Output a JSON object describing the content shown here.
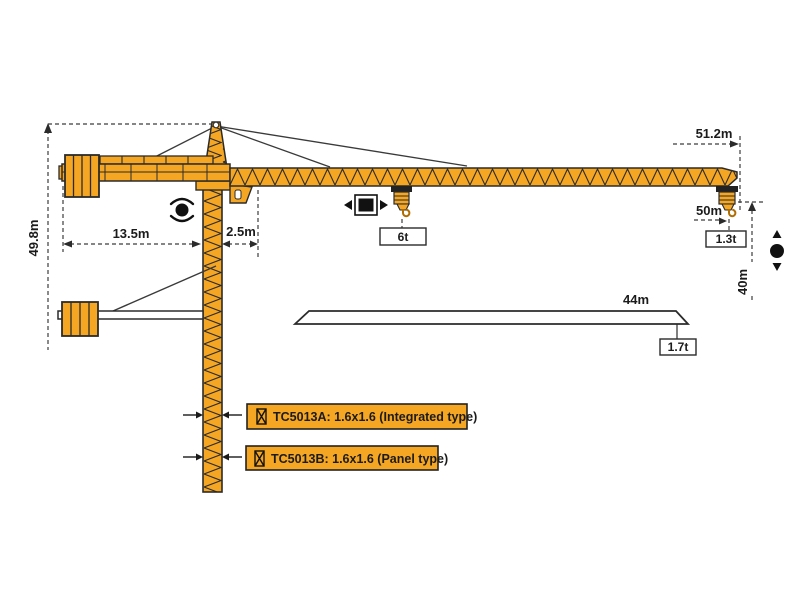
{
  "diagram": {
    "type": "tower-crane-dimension-diagram",
    "model_family": "TC5013",
    "colors": {
      "crane_orange": "#F5A623",
      "outline": "#2B2B2B",
      "dimension_line": "#3C3C3C",
      "label_box_fill": "#F5A623",
      "background": "#FFFFFF"
    },
    "dims": {
      "total_height": "49.8m",
      "counterjib_radius": "13.5m",
      "rear_clearance": "2.5m",
      "max_radius": "51.2m",
      "rope_length": "50m",
      "under_hook_height": "40m",
      "short_jib_length": "44m"
    },
    "loads": {
      "max_load": "6t",
      "tip_load": "1.3t",
      "short_jib_tip_load": "1.7t"
    },
    "models": {
      "a": "TC5013A: 1.6x1.6 (Integrated type)",
      "b": "TC5013B: 1.6x1.6 (Panel type)"
    },
    "icons": {
      "slewing": "rotation-arrows-around-dot",
      "trolley_travel": "black-square-with-left-right-arrows",
      "hoisting": "black-dot-with-up-down-arrows",
      "mast_section": "lattice-section-glyph"
    }
  }
}
